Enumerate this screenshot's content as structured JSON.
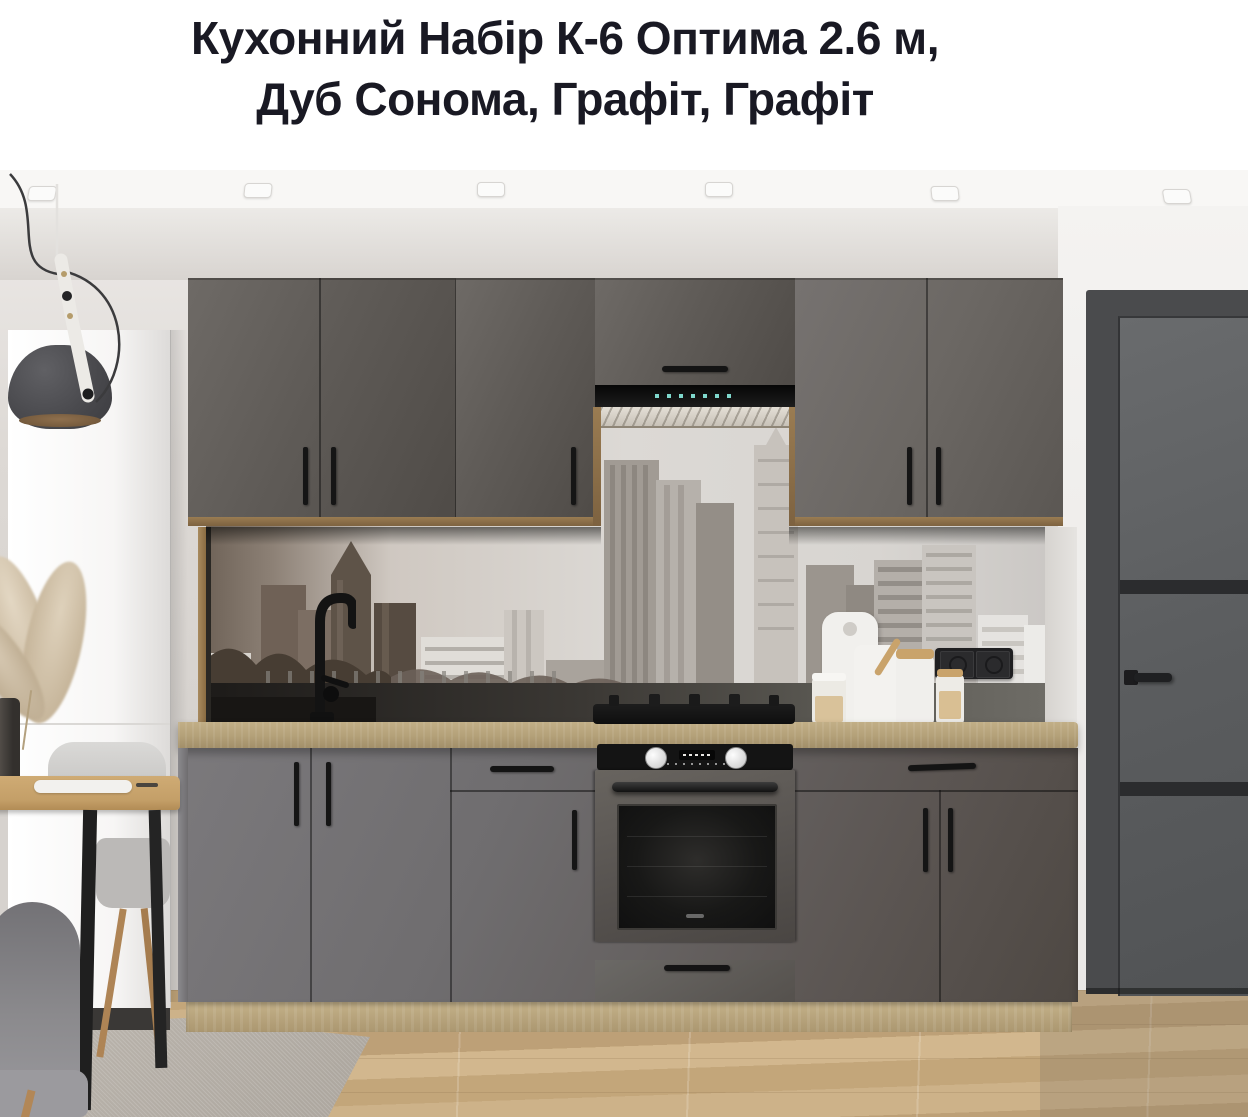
{
  "header": {
    "title_line1": "Кухонний Набір К-6 Оптима 2.6 м,",
    "title_line2": "Дуб Сонома, Графіт, Графіт",
    "text_color": "#191923"
  },
  "photo": {
    "palette": {
      "cabinet_graphite": "#5f5b57",
      "countertop_sonoma_oak": "#b5a27a",
      "wood_trim_oak": "#8b7049",
      "floor_oak": "#c9ad82",
      "wall": "#d8d4d0",
      "ceiling": "#f8f7f5",
      "fridge_white": "#fafafa",
      "backsplash_sky": "#dcd9d5",
      "backsplash_dark_band": "#3b3834",
      "interior_door_gray": "#5b5d5f",
      "appliance_black": "#141414",
      "rug_gray": "#b6b0a8",
      "pampas_beige": "#d8c9b4"
    }
  }
}
